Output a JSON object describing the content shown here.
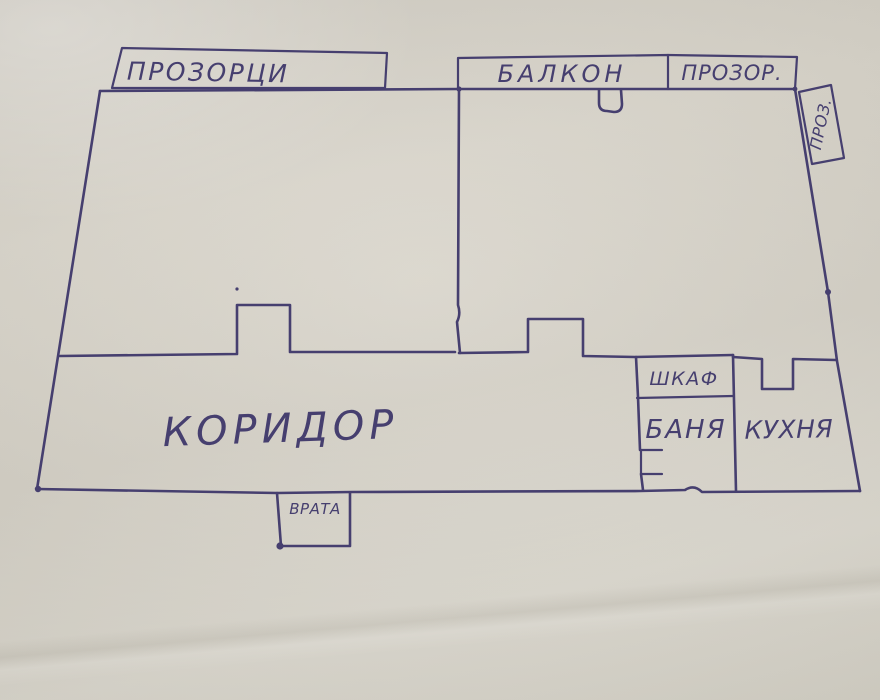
{
  "colors": {
    "ink": "#463f6f",
    "paper": "#d8d4ca"
  },
  "floor_plan": {
    "type": "hand-drawn apartment floor plan sketch, blue ink on paper",
    "exterior_annotations": {
      "windows_left": {
        "label": "ПРОЗОРЦИ"
      },
      "balcony": {
        "label": "БАЛКОН"
      },
      "window_top_right": {
        "label": "ПРОЗОР."
      },
      "window_side_right": {
        "label": "ПРОЗ."
      }
    },
    "rooms": {
      "corridor": {
        "label": "КОРИДОР"
      },
      "closet": {
        "label": "ШКАФ"
      },
      "bathroom": {
        "label": "БАНЯ"
      },
      "kitchen": {
        "label": "КУХНЯ"
      }
    },
    "entrance": {
      "label": "ВРАТА"
    }
  }
}
